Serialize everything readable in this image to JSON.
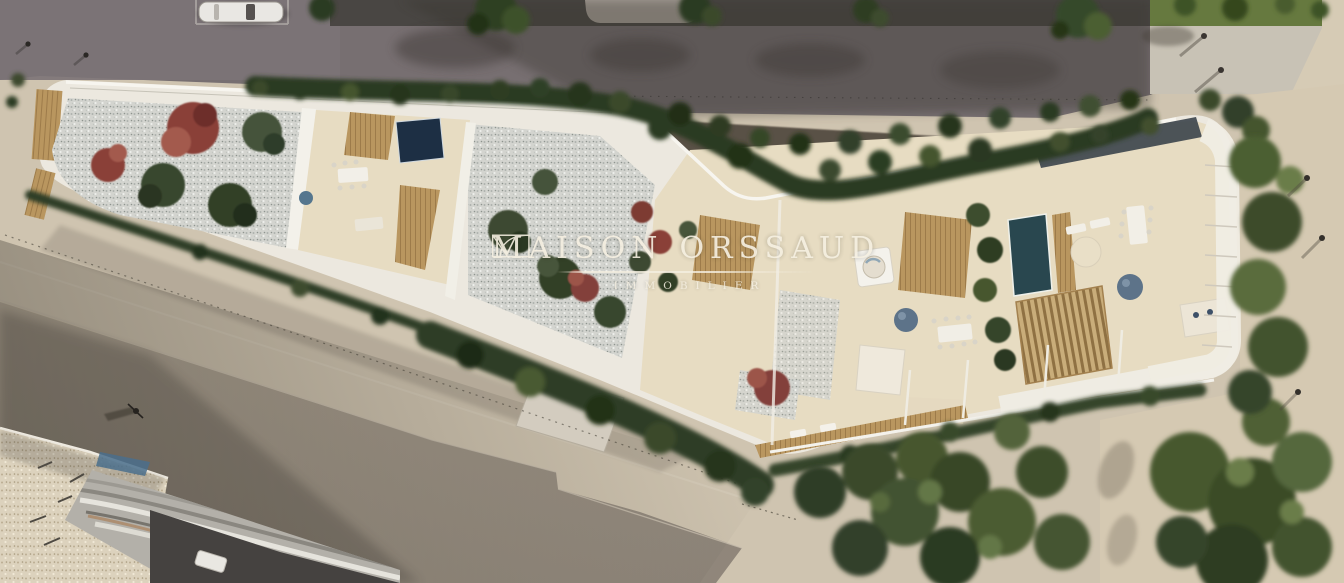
{
  "meta": {
    "kind": "aerial architectural render of a residential rooftop project",
    "width_px": 1344,
    "height_px": 583
  },
  "watermark": {
    "brand_left": "MAISON",
    "brand_right": "ORSSAUD",
    "tagline": "IMMOBILIER",
    "logo_icon": "door-arc-monogram-icon",
    "text_color": "#f5efe1"
  },
  "palette": {
    "street_beige": "#cfc4b0",
    "road_top_gray": "#776f71",
    "road_dark_strip": "#45423f",
    "hedge_green_dark": "#2c3a23",
    "tree_green": "#46562f",
    "lawn_green": "#66793f",
    "building_white": "#ece8df",
    "terrace_beige": "#e7dcc2",
    "gravel_gray": "#d3d4cf",
    "wood_deck": "#b9965f",
    "pool_navy": "#1d2f44",
    "pool_teal": "#29474f",
    "shrub_red": "#8a4038",
    "umbrella_blue": "#5d7389",
    "sand_right": "#d5c9b2"
  },
  "scene": {
    "regions": [
      {
        "name": "top-street",
        "desc": "upper roadway with parked white car and tree shadows"
      },
      {
        "name": "lawn-and-path-top-right",
        "desc": "lawn, pedestrian path, walkers with long shadows"
      },
      {
        "name": "north-hedge",
        "desc": "dense hedge between road and building"
      },
      {
        "name": "new-building",
        "desc": "bent white residential building with roof gardens, terraces, two pools, jacuzzi, pergola"
      },
      {
        "name": "south-street",
        "desc": "wide beige street with roadway band, driveway pad, cyclist"
      },
      {
        "name": "old-building-bottom-left",
        "desc": "existing building with gravel roof and wavy metal roof"
      },
      {
        "name": "south-garden",
        "desc": "dense tree masses and sand paths below the building"
      }
    ]
  }
}
